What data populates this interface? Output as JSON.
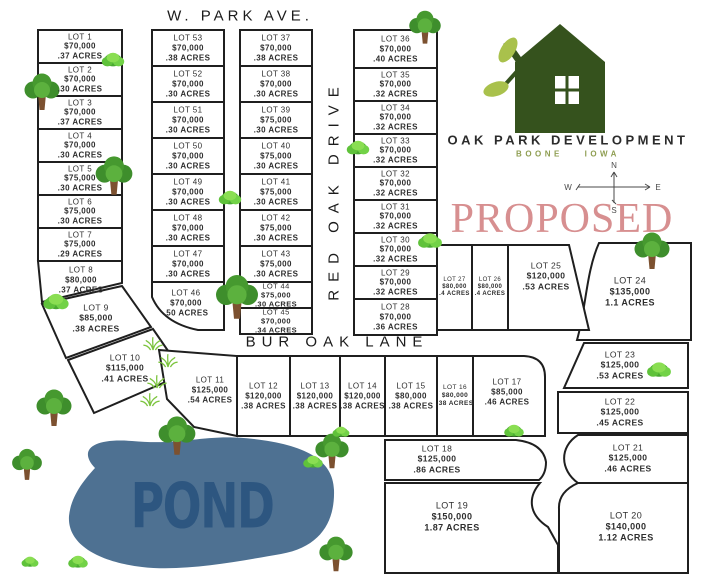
{
  "streets": {
    "top": "W. PARK AVE.",
    "vertical": "RED OAK DRIVE",
    "middle": "BUR OAK LANE"
  },
  "logo": {
    "title": "OAK PARK DEVELOPMENT",
    "subtitle": "BOONE IOWA"
  },
  "status": {
    "label": "PROPOSED"
  },
  "pond": {
    "label": "POND"
  },
  "compass": {
    "n": "N",
    "e": "E",
    "s": "S",
    "w": "W"
  },
  "colors": {
    "parcel_line": "#1f1f1f",
    "logo_green": "#35521d",
    "leaf_green": "#a9c14c",
    "subtitle_olive": "#8f9e52",
    "proposed_red": "#d78f90",
    "pond_fill": "#4e7192",
    "pond_text": "#2d5680",
    "tree_green": "#46992f"
  },
  "icons": [
    "house-icon",
    "compass-rose-icon",
    "tree-icon",
    "bush-icon",
    "grass-icon",
    "pond-shape"
  ],
  "lots": [
    {
      "name": "LOT 1",
      "price": "$70,000",
      "acres": ".37 ACRES"
    },
    {
      "name": "LOT 2",
      "price": "$70,000",
      "acres": ".30 ACRES"
    },
    {
      "name": "LOT 3",
      "price": "$70,000",
      "acres": ".37 ACRES"
    },
    {
      "name": "LOT 4",
      "price": "$70,000",
      "acres": ".30 ACRES"
    },
    {
      "name": "LOT 5",
      "price": "$75,000",
      "acres": ".30 ACRES"
    },
    {
      "name": "LOT 6",
      "price": "$75,000",
      "acres": ".30 ACRES"
    },
    {
      "name": "LOT 7",
      "price": "$75,000",
      "acres": ".29 ACRES"
    },
    {
      "name": "LOT 8",
      "price": "$80,000",
      "acres": ".37 ACRES"
    },
    {
      "name": "LOT 9",
      "price": "$85,000",
      "acres": ".38 ACRES"
    },
    {
      "name": "LOT 10",
      "price": "$115,000",
      "acres": ".41 ACRES"
    },
    {
      "name": "LOT 11",
      "price": "$125,000",
      "acres": ".54 ACRES"
    },
    {
      "name": "LOT 12",
      "price": "$120,000",
      "acres": ".38 ACRES"
    },
    {
      "name": "LOT 13",
      "price": "$120,000",
      "acres": ".38 ACRES"
    },
    {
      "name": "LOT 14",
      "price": "$120,000",
      "acres": ".38 ACRES"
    },
    {
      "name": "LOT 15",
      "price": "$80,000",
      "acres": ".38 ACRES"
    },
    {
      "name": "LOT 16",
      "price": "$80,000",
      "acres": ".38 ACRES"
    },
    {
      "name": "LOT 17",
      "price": "$85,000",
      "acres": ".46 ACRES"
    },
    {
      "name": "LOT 18",
      "price": "$125,000",
      "acres": ".86 ACRES"
    },
    {
      "name": "LOT 19",
      "price": "$150,000",
      "acres": "1.87 ACRES"
    },
    {
      "name": "LOT 20",
      "price": "$140,000",
      "acres": "1.12 ACRES"
    },
    {
      "name": "LOT 21",
      "price": "$125,000",
      "acres": ".46 ACRES"
    },
    {
      "name": "LOT 22",
      "price": "$125,000",
      "acres": ".45 ACRES"
    },
    {
      "name": "LOT 23",
      "price": "$125,000",
      "acres": ".53 ACRES"
    },
    {
      "name": "LOT 24",
      "price": "$135,000",
      "acres": "1.1 ACRES"
    },
    {
      "name": "LOT 25",
      "price": "$120,000",
      "acres": ".53 ACRES"
    },
    {
      "name": "LOT 26",
      "price": "$80,000",
      "acres": ".4 ACRES"
    },
    {
      "name": "LOT 27",
      "price": "$80,000",
      "acres": ".4 ACRES"
    },
    {
      "name": "LOT 28",
      "price": "$70,000",
      "acres": ".36 ACRES"
    },
    {
      "name": "LOT 29",
      "price": "$70,000",
      "acres": ".32 ACRES"
    },
    {
      "name": "LOT 30",
      "price": "$70,000",
      "acres": ".32 ACRES"
    },
    {
      "name": "LOT 31",
      "price": "$70,000",
      "acres": ".32 ACRES"
    },
    {
      "name": "LOT 32",
      "price": "$70,000",
      "acres": ".32 ACRES"
    },
    {
      "name": "LOT 33",
      "price": "$70,000",
      "acres": ".32 ACRES"
    },
    {
      "name": "LOT 34",
      "price": "$70,000",
      "acres": ".32 ACRES"
    },
    {
      "name": "LOT 35",
      "price": "$70,000",
      "acres": ".32 ACRES"
    },
    {
      "name": "LOT 36",
      "price": "$70,000",
      "acres": ".40 ACRES"
    },
    {
      "name": "LOT 37",
      "price": "$70,000",
      "acres": ".38 ACRES"
    },
    {
      "name": "LOT 38",
      "price": "$70,000",
      "acres": ".30 ACRES"
    },
    {
      "name": "LOT 39",
      "price": "$75,000",
      "acres": ".30 ACRES"
    },
    {
      "name": "LOT 40",
      "price": "$75,000",
      "acres": ".30 ACRES"
    },
    {
      "name": "LOT 41",
      "price": "$75,000",
      "acres": ".30 ACRES"
    },
    {
      "name": "LOT 42",
      "price": "$75,000",
      "acres": ".30 ACRES"
    },
    {
      "name": "LOT 43",
      "price": "$75,000",
      "acres": ".30 ACRES"
    },
    {
      "name": "LOT 44",
      "price": "$75,000",
      "acres": ".30 ACRES"
    },
    {
      "name": "LOT 45",
      "price": "$70,000",
      "acres": ".34 ACRES"
    },
    {
      "name": "LOT 46",
      "price": "$70,000",
      "acres": ".50 ACRES"
    },
    {
      "name": "LOT 47",
      "price": "$70,000",
      "acres": ".30 ACRES"
    },
    {
      "name": "LOT 48",
      "price": "$70,000",
      "acres": ".30 ACRES"
    },
    {
      "name": "LOT 49",
      "price": "$70,000",
      "acres": ".30 ACRES"
    },
    {
      "name": "LOT 50",
      "price": "$70,000",
      "acres": ".30 ACRES"
    },
    {
      "name": "LOT 51",
      "price": "$70,000",
      "acres": ".30 ACRES"
    },
    {
      "name": "LOT 52",
      "price": "$70,000",
      "acres": ".30 ACRES"
    },
    {
      "name": "LOT 53",
      "price": "$70,000",
      "acres": ".38 ACRES"
    }
  ]
}
